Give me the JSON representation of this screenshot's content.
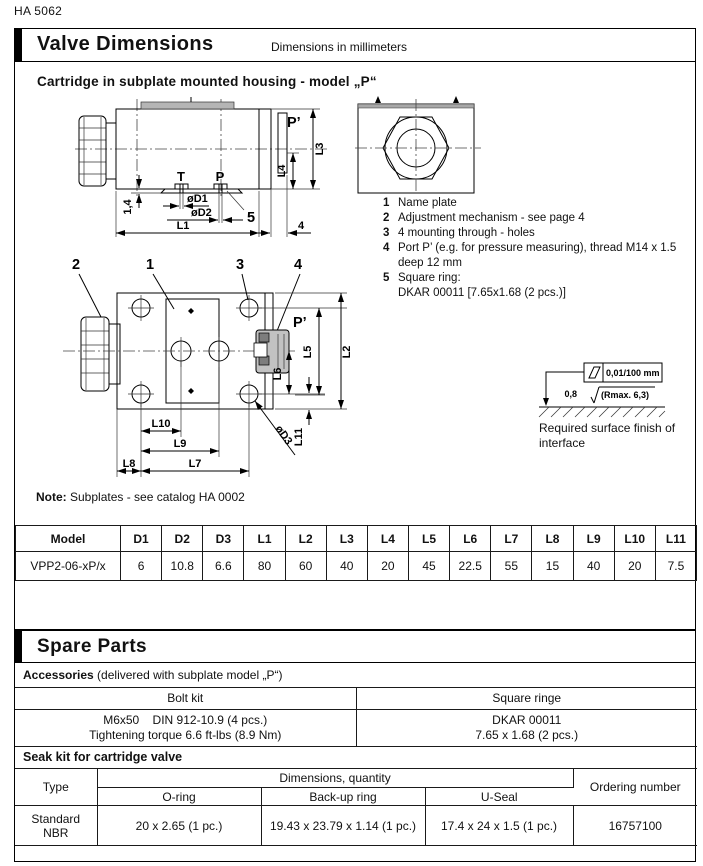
{
  "doc_number": "HA 5062",
  "header": {
    "title": "Valve Dimensions",
    "units": "Dimensions in millimeters"
  },
  "section_heading": "Cartridge in subplate mounted housing - model „P“",
  "callouts": [
    {
      "num": "1",
      "text": "Name plate"
    },
    {
      "num": "2",
      "text": "Adjustment mechanism - see page 4"
    },
    {
      "num": "3",
      "text": "4 mounting through - holes"
    },
    {
      "num": "4",
      "text": "Port P’ (e.g. for pressure measuring), thread M14 x 1.5\ndeep 12 mm"
    },
    {
      "num": "5",
      "text": "Square ring:\nDKAR 00011 [7.65x1.68 (2 pcs.)]"
    }
  ],
  "surface_finish": {
    "flatness": "0,01/100 mm",
    "roughness_value": "0,8",
    "roughness_max": "(Rmax. 6,3)",
    "caption": "Required surface finish of interface"
  },
  "note": {
    "label": "Note:",
    "text": " Subplates - see catalog HA 0002"
  },
  "side_view": {
    "port_t": "T",
    "port_p": "P",
    "port_p_prime": "P’",
    "l1": "L1",
    "l3": "L3",
    "l4": "L4",
    "d1": "øD1",
    "d2": "øD2",
    "dim_1_4": "1,4",
    "dim_4": "4",
    "item_5": "5"
  },
  "top_view": {
    "c1": "1",
    "c2": "2",
    "c3": "3",
    "c4": "4",
    "p_prime": "P’",
    "l2": "L2",
    "l5": "L5",
    "l6": "L6",
    "l7": "L7",
    "l8": "L8",
    "l9": "L9",
    "l10": "L10",
    "l11": "L11",
    "d3": "øD3"
  },
  "dim_table": {
    "headers": [
      "Model",
      "D1",
      "D2",
      "D3",
      "L1",
      "L2",
      "L3",
      "L4",
      "L5",
      "L6",
      "L7",
      "L8",
      "L9",
      "L10",
      "L11"
    ],
    "row": [
      "VPP2-06-xP/x",
      "6",
      "10.8",
      "6.6",
      "80",
      "60",
      "40",
      "20",
      "45",
      "22.5",
      "55",
      "15",
      "40",
      "20",
      "7.5"
    ]
  },
  "spare_parts": {
    "heading": "Spare Parts",
    "accessories_bold": "Accessories",
    "accessories_rest": " (delivered with subplate model „P“)",
    "bolt_kit_header": "Bolt kit",
    "bolt_kit_lines": "M6x50    DIN 912-10.9 (4 pcs.)\nTightening torque 6.6 ft-lbs (8.9 Nm)",
    "square_ring_header": "Square ringe",
    "square_ring_lines": "DKAR 00011\n7.65 x 1.68 (2 pcs.)",
    "seal_kit_heading": "Seak kit for cartridge valve",
    "seal_table": {
      "col_type": "Type",
      "col_dims": "Dimensions, quantity",
      "col_order": "Ordering number",
      "sub_oring": "O-ring",
      "sub_backup": "Back-up ring",
      "sub_useal": "U-Seal",
      "row_type": "Standard\nNBR",
      "row_oring": "20 x 2.65 (1 pc.)",
      "row_backup": "19.43 x 23.79 x 1.14 (1 pc.)",
      "row_useal": "17.4 x 24 x 1.5 (1 pc.)",
      "row_order": "16757100"
    }
  }
}
